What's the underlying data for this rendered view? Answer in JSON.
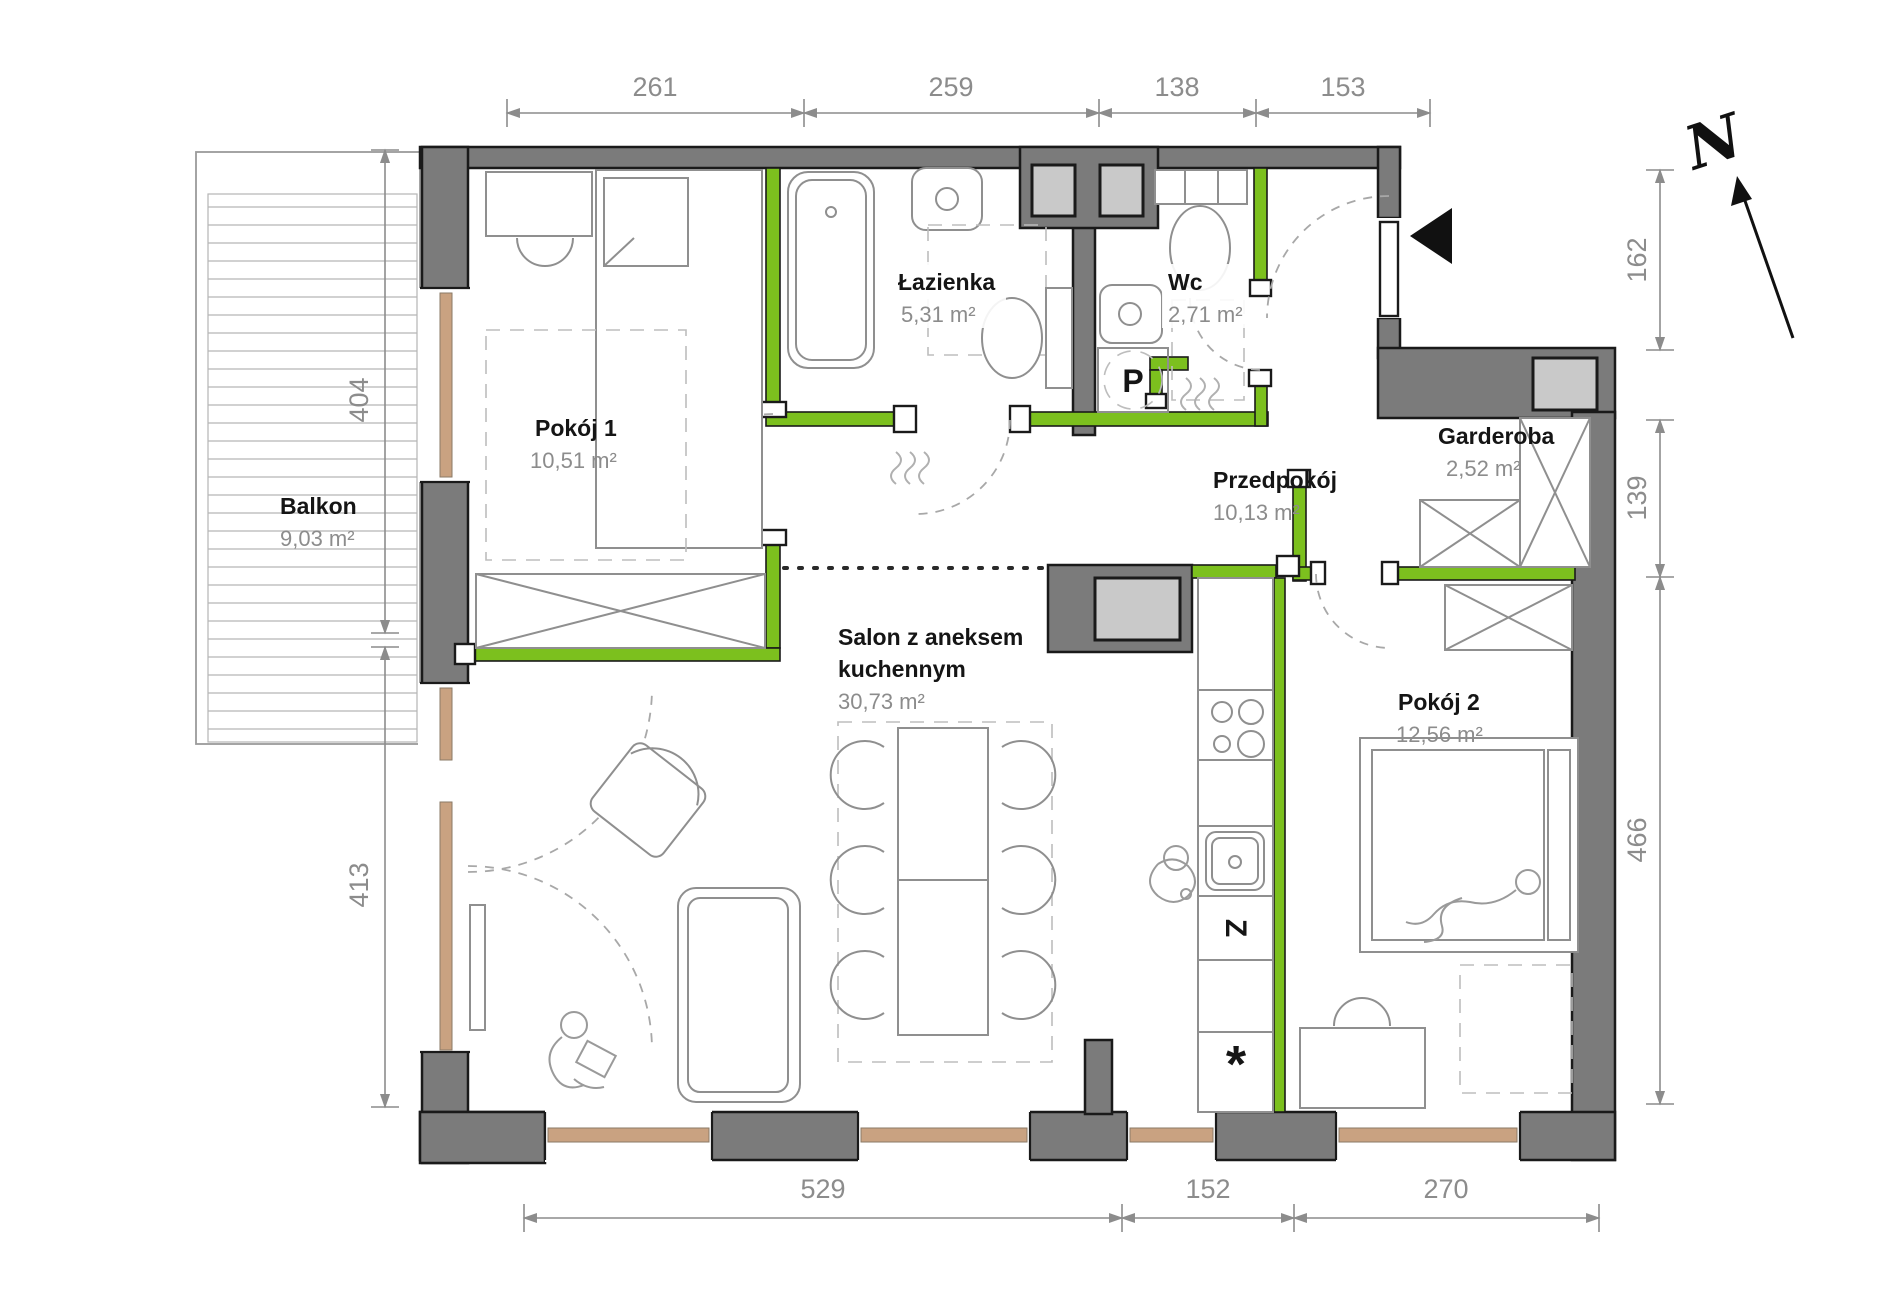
{
  "title": "Rzut mieszkania",
  "rooms": [
    {
      "id": "balkon",
      "name": "Balkon",
      "area": "9,03 m²"
    },
    {
      "id": "pokoj1",
      "name": "Pokój 1",
      "area": "10,51 m²"
    },
    {
      "id": "lazienka",
      "name": "Łazienka",
      "area": "5,31 m²"
    },
    {
      "id": "wc",
      "name": "Wc",
      "area": "2,71 m²"
    },
    {
      "id": "przedpokoj",
      "name": "Przedpokój",
      "area": "10,13 m²"
    },
    {
      "id": "garderoba",
      "name": "Garderoba",
      "area": "2,52 m²"
    },
    {
      "id": "salon",
      "name_line1": "Salon z aneksem",
      "name_line2": "kuchennym",
      "area": "30,73 m²"
    },
    {
      "id": "pokoj2",
      "name": "Pokój 2",
      "area": "12,56 m²"
    }
  ],
  "dimensions": {
    "top": [
      "261",
      "259",
      "138",
      "153"
    ],
    "bottom": [
      "529",
      "152",
      "270"
    ],
    "left": [
      "404",
      "413"
    ],
    "right": [
      "162",
      "139",
      "466"
    ]
  },
  "markers": {
    "north": "N",
    "washing_machine": "P",
    "dishwasher": "Z",
    "fridge_star": "*"
  },
  "colors": {
    "wall": "#7b7b7b",
    "accent_green": "#7cc01e",
    "shaft": "#c9c9c9",
    "wood": "#c9a281"
  }
}
